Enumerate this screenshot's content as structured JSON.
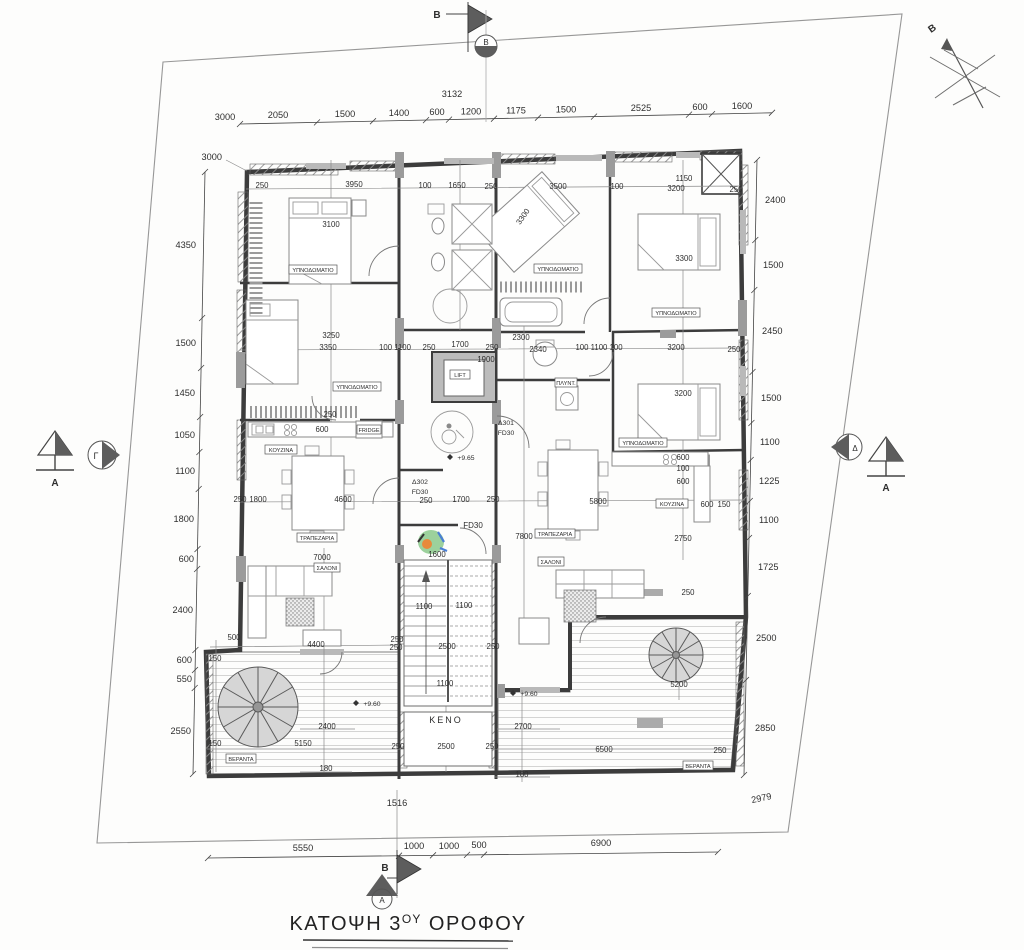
{
  "title": {
    "p1": "ΚΑΤΟΨΗ 3",
    "sup": "ΟΥ",
    "p2": " ΟΡΟΦΟΥ"
  },
  "compass": {
    "north_label": "B"
  },
  "markers": {
    "b": "B",
    "a": "A",
    "gamma": "Γ",
    "delta": "Δ"
  },
  "rooms": {
    "bedroom": "ΥΠΝΟΔΩΜΑΤΙΟ",
    "kitchen": "ΚΟΥΖΙΝΑ",
    "dining": "ΤΡΑΠΕΖΑΡΙΑ",
    "living": "ΣΑΛΟΝΙ",
    "veranda": "ΒΕΡΑΝΤΑ",
    "lift": "LIFT",
    "void": "ΚΕΝΟ",
    "fridge": "FRIDGE",
    "laundry": "ΠΛΥΝΤ."
  },
  "doors": {
    "d301": "Δ301",
    "d302": "Δ302",
    "fd30": "FD30"
  },
  "levels": {
    "l965": "+9.65",
    "l960": "+9.60"
  },
  "dims": {
    "top_offset": "3000",
    "top": [
      "2050",
      "1500",
      "1400",
      "600",
      "1200",
      "1175",
      "1500",
      "2525",
      "600",
      "1600"
    ],
    "top_axis": "3132",
    "left_offset": "3000",
    "left": [
      "4350",
      "1500",
      "1450",
      "1050",
      "1100",
      "1800",
      "600",
      "2400",
      "600",
      "550",
      "2550"
    ],
    "right": [
      "2400",
      "1500",
      "2450",
      "1500",
      "1100",
      "1225",
      "1100",
      "1725",
      "2500",
      "2850"
    ],
    "right_diag": "2979",
    "bottom": [
      "5550",
      "1000",
      "1000",
      "500",
      "6900"
    ],
    "bottom_axis": "1516",
    "interior": [
      "3950",
      "250",
      "3100",
      "100",
      "1650",
      "250",
      "3500",
      "100",
      "1150",
      "3200",
      "250",
      "3300",
      "3300",
      "3250",
      "3350",
      "100 1100",
      "250",
      "1700",
      "250",
      "1900",
      "2300",
      "2340",
      "100 1100 100",
      "3200",
      "250",
      "3200",
      "250",
      "600",
      "600",
      "100",
      "600",
      "1800",
      "250",
      "4600",
      "1700",
      "250",
      "250",
      "5800",
      "600",
      "150",
      "2750",
      "7000",
      "7800",
      "1600",
      "1100",
      "1100",
      "2500",
      "250",
      "250",
      "1100",
      "4400",
      "500",
      "250",
      "150",
      "2400",
      "5150",
      "150",
      "180",
      "2500",
      "250",
      "250",
      "2700",
      "6500",
      "250",
      "180",
      "5200",
      "250"
    ]
  }
}
